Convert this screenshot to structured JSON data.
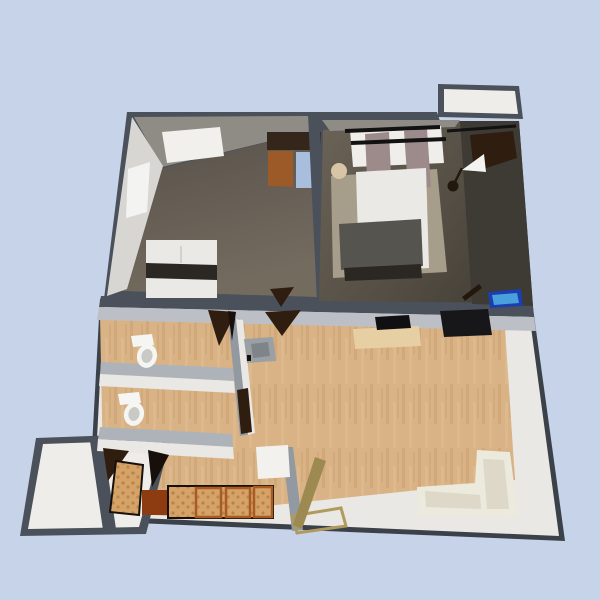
{
  "scene": {
    "name": "apartment-3d-floorplan-render",
    "view": "3d-perspective-top",
    "background": "#c6d3e9"
  },
  "colors": {
    "bg": "#c6d3e9",
    "wall_dark": "#4a515a",
    "wall_dark_edge": "#3a4149",
    "wall_face_gray": "#8f8c86",
    "wall_face_light": "#d8d6d2",
    "lower_wall_white": "#eae8e4",
    "lower_wall_top": "#aeb3ba",
    "lower_wall_front": "#bcc0c6",
    "partition_gray": "#9299a0",
    "bedroom1_floor_a": "#746b5f",
    "bedroom1_floor_b": "#57514a",
    "bedroom2_floor_a": "#6b6357",
    "bedroom2_floor_b": "#474239",
    "bedroom2_shadow": "#3e3a34",
    "wood_base": "#d9b286",
    "wood_streak_dark": "#c9a06f",
    "wood_streak_light": "#e4c096",
    "balcony_floor": "#efedea",
    "white_panel": "#f1f0ed",
    "window_white": "#f3f4f1",
    "wardrobe_top": "#35261c",
    "wardrobe_wood": "#9c5a28",
    "wardrobe_blue": "#a9bedd",
    "bed_white": "#ebe9e5",
    "bed_band_dark": "#2b2723",
    "blanket_gray": "#55544f",
    "rug_tan": "#a69d8a",
    "curtain_white": "#f0eeea",
    "curtain_mauve": "#9d8b8c",
    "headboard_tan": "#b4a480",
    "rod_black": "#121212",
    "stool_beige": "#d8c5a5",
    "door_brown": "#2f1d10",
    "door_black": "#17100a",
    "guitar_dark": "#22180e",
    "blue_box_dark": "#1b3fb0",
    "blue_box_light": "#4aa0dc",
    "tv_black": "#17171a",
    "picture_black": "#101012",
    "desk_tan": "#e6cfa2",
    "sofa_cream": "#ece9dd",
    "sofa_shade": "#ddd8c7",
    "toilet_white": "#f5f5f3",
    "toilet_shade": "#c9c9c5",
    "sink_gray": "#9aa0a4",
    "sink_inner": "#7e8488",
    "counter_base": "#d5a268",
    "counter_dot": "#b07c42",
    "counter_border": "#a85c24",
    "stove_brown": "#8c3c10",
    "fridge_white": "#f2f1ee",
    "entry_door_olive": "#9d8a50",
    "threshold_tan": "#b09a5e"
  },
  "rooms": [
    {
      "id": "bedroom-1",
      "label": "bedroom 1"
    },
    {
      "id": "bedroom-2",
      "label": "bedroom 2"
    },
    {
      "id": "living-room",
      "label": "living room"
    },
    {
      "id": "bathroom-1",
      "label": "bathroom 1"
    },
    {
      "id": "bathroom-2",
      "label": "bathroom 2"
    },
    {
      "id": "kitchen",
      "label": "kitchen"
    },
    {
      "id": "hallway",
      "label": "hallway"
    },
    {
      "id": "balcony-top",
      "label": "top balcony"
    },
    {
      "id": "balcony-bottom",
      "label": "bottom balcony"
    }
  ],
  "objects": [
    {
      "id": "bed-1",
      "label": "single bed"
    },
    {
      "id": "bed-2",
      "label": "double bed with curtains"
    },
    {
      "id": "wardrobe",
      "label": "two-door wardrobe"
    },
    {
      "id": "stool",
      "label": "round stool"
    },
    {
      "id": "wall-guitar",
      "label": "wall guitar"
    },
    {
      "id": "blue-box",
      "label": "blue box"
    },
    {
      "id": "laptop",
      "label": "dark leaning object"
    },
    {
      "id": "tv",
      "label": "wall tv"
    },
    {
      "id": "wall-picture",
      "label": "wall picture"
    },
    {
      "id": "desk",
      "label": "console desk"
    },
    {
      "id": "sofa",
      "label": "corner sofa"
    },
    {
      "id": "toilet-1",
      "label": "toilet"
    },
    {
      "id": "toilet-2",
      "label": "toilet"
    },
    {
      "id": "sink",
      "label": "washbasin"
    },
    {
      "id": "kitchen-counter",
      "label": "kitchen counters"
    },
    {
      "id": "stove",
      "label": "stove cabinet"
    },
    {
      "id": "fridge",
      "label": "fridge"
    },
    {
      "id": "entry-door",
      "label": "entry door"
    }
  ]
}
